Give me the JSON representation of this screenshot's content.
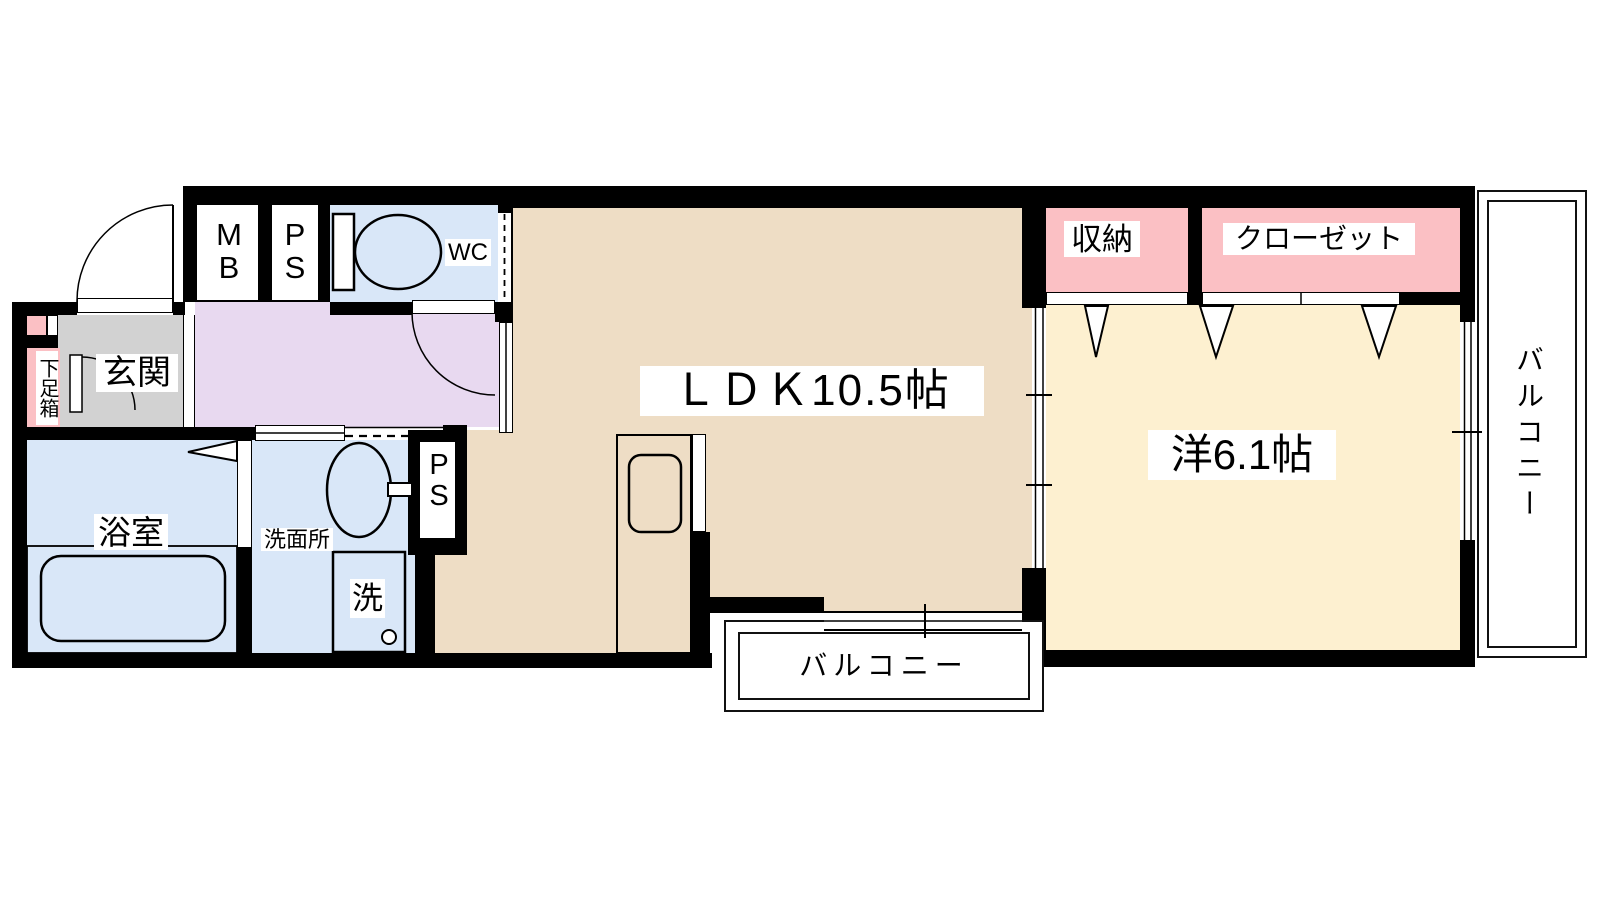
{
  "floorplan": {
    "labels": {
      "genkan": "玄関",
      "shoe_box": "下足箱",
      "mb": "MB",
      "ps_top": "PS",
      "wc": "WC",
      "bathroom": "浴室",
      "washroom": "洗面所",
      "washer": "洗",
      "ps_mid": "PS",
      "ldk": "ＬＤＫ10.5帖",
      "western_room": "洋6.1帖",
      "storage": "収納",
      "closet": "クローゼット",
      "balcony_right": "バルコニー",
      "balcony_bottom": "バルコニー"
    },
    "colors": {
      "wall": "#000000",
      "ldk_floor": "#eeddc5",
      "western_floor": "#fdf0d0",
      "storage_pink": "#fbc0c4",
      "hallway_lavender": "#e8d9f0",
      "water_blue": "#d9e7f8",
      "genkan_gray": "#d2d2d2",
      "background": "#ffffff"
    }
  }
}
